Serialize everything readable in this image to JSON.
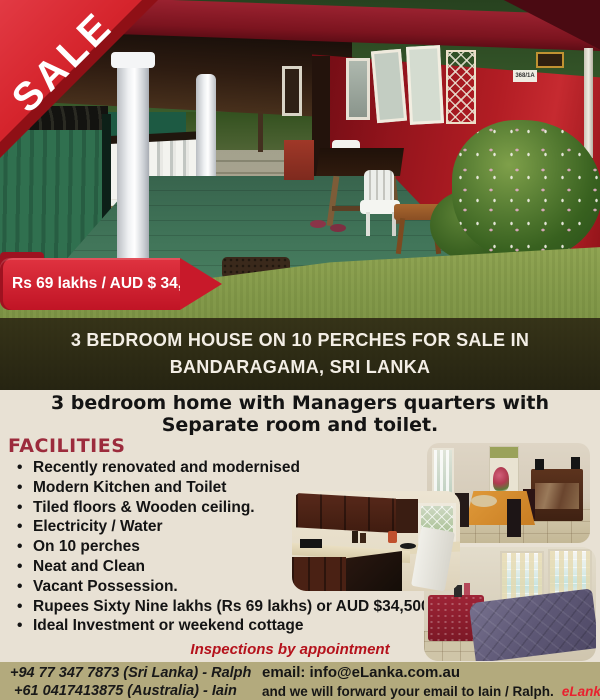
{
  "sale_ribbon": {
    "label": "SALE"
  },
  "price_banner": {
    "text": "Rs 69 lakhs / AUD $ 34,500"
  },
  "main_photo": {
    "name": "exterior-photo-red-house-with-carport",
    "house_number_sign": "368/1A"
  },
  "title_banner": {
    "line1": "3 BEDROOM HOUSE ON 10 PERCHES FOR SALE IN",
    "line2": "BANDARAGAMA, SRI LANKA"
  },
  "subtitle": {
    "line1": "3 bedroom home with Managers quarters with",
    "line2": "Separate room and toilet."
  },
  "facilities": {
    "heading": "FACILITIES",
    "items": [
      "Recently renovated and modernised",
      "Modern Kitchen and Toilet",
      "Tiled floors & Wooden ceiling.",
      "Electricity / Water",
      "On 10 perches",
      "Neat and Clean",
      "Vacant Possession.",
      "Rupees  Sixty Nine lakhs (Rs 69 lakhs) or AUD $34,500",
      "Ideal Investment or weekend cottage"
    ]
  },
  "interior_photos": {
    "dining": "dining-room-photo",
    "kitchen": "kitchen-photo",
    "bedroom": "bedroom-photo"
  },
  "inspection_note": "Inspections by appointment",
  "footer": {
    "phone_sri_lanka": "+94 77 347 7873 (Sri Lanka)  - Ralph",
    "phone_australia": "+61 0417413875 (Australia) - Iain",
    "email_line": "email: info@eLanka.com.au",
    "forward_line": "and we will forward your email to Iain / Ralph.",
    "brand": "eLanka"
  },
  "colors": {
    "accent_red": "#d01c2a",
    "maroon_heading": "#9c2b3c",
    "note_red": "#b5121c",
    "brand_red": "#e8212e",
    "footer_olive": "#b3aa7d",
    "page_beige": "#e8e1d4"
  }
}
